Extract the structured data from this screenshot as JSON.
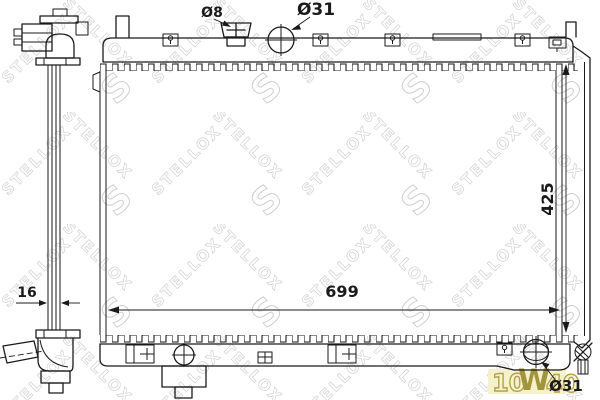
{
  "labels": {
    "dia8": "Ø8",
    "dia31_top": "Ø31",
    "height": "425",
    "width": "699",
    "thickness": "16",
    "dia31_bottom": "Ø31"
  },
  "watermark": {
    "brand": "STELLOX",
    "logo": "S",
    "oil_left": "10",
    "oil_mid": "W",
    "oil_right": "40"
  },
  "colors": {
    "line": "#1a1a1a",
    "watermark_gray": "#d6d6d6",
    "oil_text": "#b3a24a",
    "oil_bg": "#f4f0c8"
  }
}
